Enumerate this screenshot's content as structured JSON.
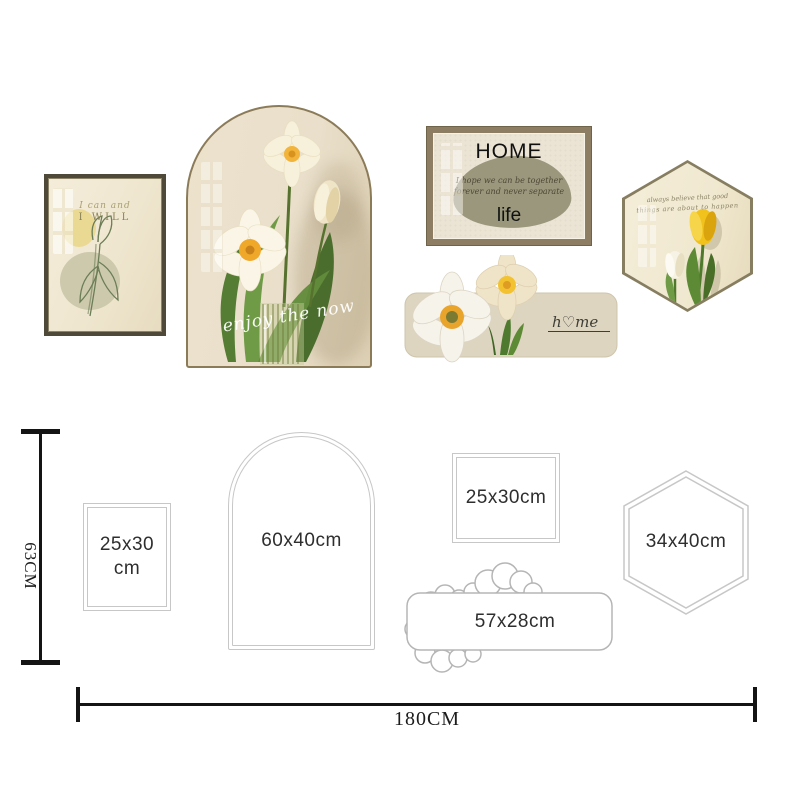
{
  "product": {
    "lineart_frame": {
      "line1": "I can and",
      "line2": "I WILL"
    },
    "arch_frame": {
      "script": "enjoy the now"
    },
    "home_frame": {
      "title": "HOME",
      "quote1": "I hope we can be together",
      "quote2": "forever and never separate",
      "word": "life"
    },
    "hex_frame": {
      "script1": "always believe that good",
      "script2": "things are about to happen"
    },
    "flower_sign": {
      "script": "h♡me"
    }
  },
  "diagram": {
    "height_label": "63CM",
    "width_label": "180CM",
    "sizes": {
      "small_rect_line1": "25x30",
      "small_rect_line2": "cm",
      "arch": "60x40cm",
      "landscape_rect": "25x30cm",
      "cloud": "57x28cm",
      "hexagon": "34x40cm"
    }
  },
  "colors": {
    "tulip_yellow": "#f1c11c",
    "flower_center_orange": "#efa82c",
    "leaf_green": "#5d8a35",
    "frame_brown": "#8d7e63",
    "canvas_cream": "#e9dfca",
    "blob_olive": "#9a977d",
    "diagram_outline": "#c7c7c7",
    "measure_black": "#141414"
  }
}
